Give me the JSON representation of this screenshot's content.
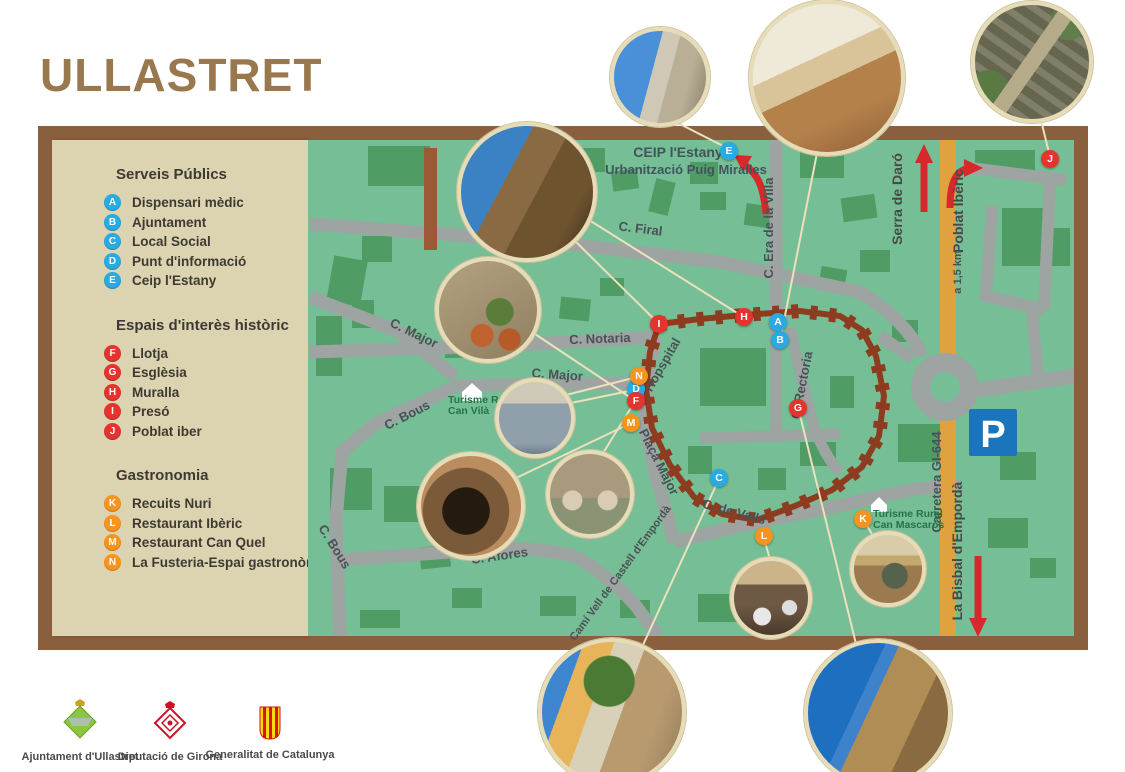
{
  "title": "ULLASTRET",
  "colors": {
    "frame_brown": "#8A5F3E",
    "map_green": "#76BE95",
    "patch_green": "#4F9C64",
    "road_gray": "#9EA4A2",
    "road_orange": "#E0A23E",
    "wall_brown": "#8E3C20",
    "marker_blue": "#29ABE2",
    "marker_red": "#E5332E",
    "marker_orange": "#F7941E",
    "arrow_red": "#D7292B",
    "parking_blue": "#1B75BC",
    "legend_beige": "#DCD3B0",
    "title_brown": "#9A784E"
  },
  "legend": {
    "sections": [
      {
        "title": "Serveis Públics",
        "category": "public",
        "color": "#29ABE2",
        "items": [
          {
            "letter": "A",
            "label": "Dispensari mèdic"
          },
          {
            "letter": "B",
            "label": "Ajuntament"
          },
          {
            "letter": "C",
            "label": "Local Social"
          },
          {
            "letter": "D",
            "label": "Punt d'informació"
          },
          {
            "letter": "E",
            "label": "Ceip l'Estany"
          }
        ]
      },
      {
        "title": "Espais d'interès històric",
        "category": "historic",
        "color": "#E5332E",
        "items": [
          {
            "letter": "F",
            "label": "Llotja"
          },
          {
            "letter": "G",
            "label": "Esglèsia"
          },
          {
            "letter": "H",
            "label": "Muralla"
          },
          {
            "letter": "I",
            "label": "Presó"
          },
          {
            "letter": "J",
            "label": "Poblat iber"
          }
        ]
      },
      {
        "title": "Gastronomia",
        "category": "gastronomy",
        "color": "#F7941E",
        "items": [
          {
            "letter": "K",
            "label": "Recuits Nuri"
          },
          {
            "letter": "L",
            "label": "Restaurant Ibèric"
          },
          {
            "letter": "M",
            "label": "Restaurant Can Quel"
          },
          {
            "letter": "N",
            "label": "La Fusteria-Espai gastronòmic"
          }
        ]
      }
    ]
  },
  "map": {
    "street_labels": {
      "c_firal": "C. Firal",
      "c_era_de_la_villa": "C. Era de la Villa",
      "c_notaria": "C. Notaria",
      "c_major_upper": "C. Major",
      "c_major_lower": "C. Major",
      "c_bous_upper": "C. Bous",
      "c_bous_lower": "C. Bous",
      "c_hospital": "C. Hopspital",
      "placa_major": "Plaça Major",
      "c_rectoria": "C. Rectoria",
      "c_de_valls": "C. de Valls",
      "c_afores": "C. Afores",
      "cami_vell": "Camí Vell de Castell d'Empordà"
    },
    "area_labels": {
      "ceip_title": "CEIP l'Estany",
      "ceip_subtitle": "Urbanització Puig Miralles",
      "serra_de_daro": "Serra de Daró",
      "poblat_iberic": "Poblat Ibèric",
      "poblat_distance": "a 1,5 km",
      "carretera": "Carretera GI-644",
      "la_bisbal": "La Bisbal d'Empordà",
      "parking": "P",
      "can_vila_line1": "Turisme Rural",
      "can_vila_line2": "Can Vilà",
      "can_mascaros_line1": "Turisme Rural",
      "can_mascaros_line2": "Can Mascarós"
    },
    "markers": [
      {
        "letter": "A",
        "category": "public"
      },
      {
        "letter": "B",
        "category": "public"
      },
      {
        "letter": "C",
        "category": "public"
      },
      {
        "letter": "D",
        "category": "public"
      },
      {
        "letter": "E",
        "category": "public"
      },
      {
        "letter": "F",
        "category": "historic"
      },
      {
        "letter": "G",
        "category": "historic"
      },
      {
        "letter": "H",
        "category": "historic"
      },
      {
        "letter": "I",
        "category": "historic"
      },
      {
        "letter": "J",
        "category": "historic"
      },
      {
        "letter": "K",
        "category": "gastronomy"
      },
      {
        "letter": "L",
        "category": "gastronomy"
      },
      {
        "letter": "M",
        "category": "gastronomy"
      },
      {
        "letter": "N",
        "category": "gastronomy"
      }
    ]
  },
  "photos": [
    {
      "id": "tower",
      "alt": "Muralla tower and stone wall"
    },
    {
      "id": "pots",
      "alt": "Stone facade with flower pots"
    },
    {
      "id": "shop",
      "alt": "Information point shop front"
    },
    {
      "id": "arcade",
      "alt": "Llotja arcade with terrace"
    },
    {
      "id": "facade",
      "alt": "Restaurant facade with umbrellas"
    },
    {
      "id": "school",
      "alt": "CEIP l'Estany school porch"
    },
    {
      "id": "courtyard",
      "alt": "Rural house courtyard"
    },
    {
      "id": "aerial",
      "alt": "Aerial view of the Iberian settlement"
    },
    {
      "id": "restaurant",
      "alt": "Restaurant dining room"
    },
    {
      "id": "mascaros",
      "alt": "Can Mascarós shop front"
    },
    {
      "id": "street",
      "alt": "Village square with plane tree"
    },
    {
      "id": "church",
      "alt": "Romanesque church of Ullastret"
    }
  ],
  "footer": {
    "logos": [
      {
        "label": "Ajuntament d'Ullastret"
      },
      {
        "label": "Diputació de Girona"
      },
      {
        "label": "Generalitat de Catalunya"
      }
    ]
  }
}
